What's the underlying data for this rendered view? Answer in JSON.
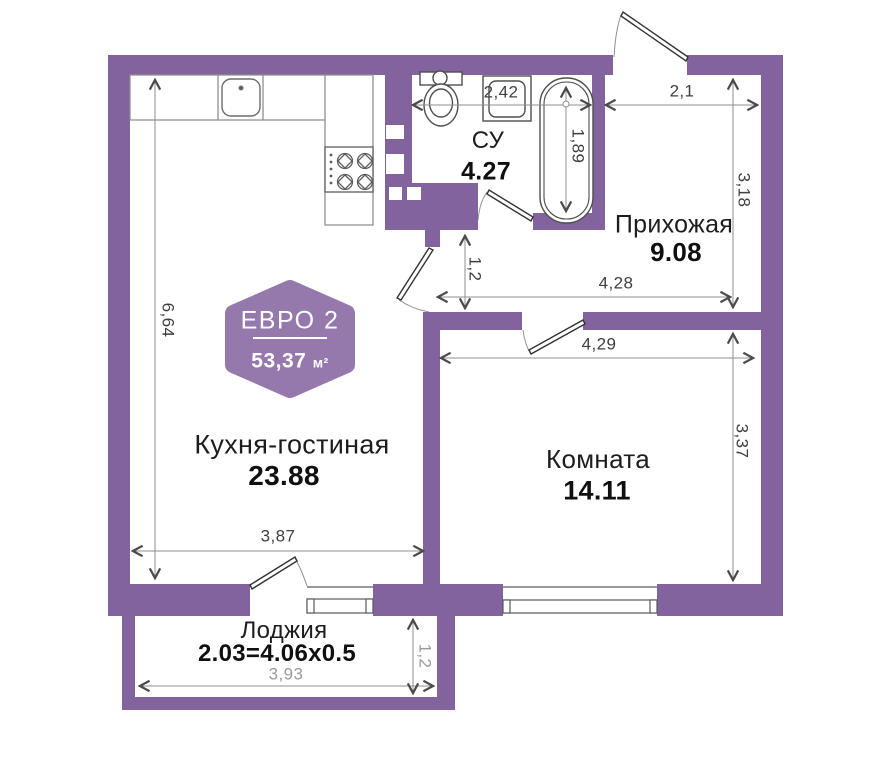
{
  "plan": {
    "badge": {
      "title": "ЕВРО 2",
      "area_value": "53,37",
      "area_unit": "м²"
    },
    "rooms": {
      "kitchen": {
        "name": "Кухня-гостиная",
        "area": "23.88"
      },
      "bedroom": {
        "name": "Комната",
        "area": "14.11"
      },
      "hallway": {
        "name": "Прихожая",
        "area": "9.08"
      },
      "bathroom": {
        "name": "СУ",
        "area": "4.27"
      },
      "loggia": {
        "name": "Лоджия",
        "formula": "2.03=4.06х0.5"
      }
    },
    "dimensions": {
      "bathroom_width": "2,42",
      "entry_width": "2,1",
      "bathtub_length": "1,89",
      "hallway_depth": "3,18",
      "corridor_width": "1,2",
      "hallway_width": "4,28",
      "bedroom_width": "4,29",
      "bedroom_depth": "3,37",
      "kitchen_depth": "6,64",
      "kitchen_width": "3,87",
      "loggia_width": "3,93",
      "loggia_depth": "1,2"
    },
    "colors": {
      "wall": "#82639d",
      "badge": "#9579ad",
      "dim_dark": "#3f3f3f",
      "dim_gray": "#9a9a9a"
    }
  }
}
